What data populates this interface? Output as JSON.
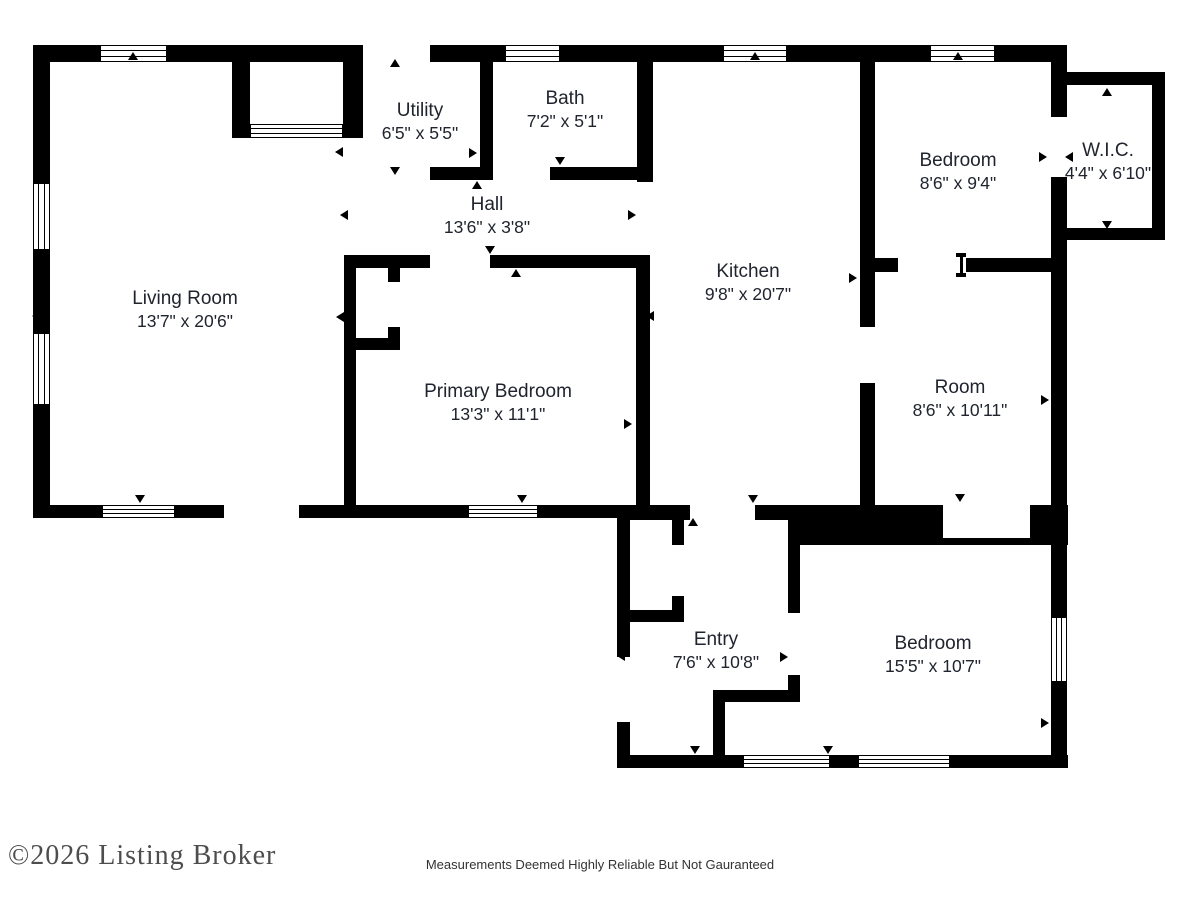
{
  "floor_plan": {
    "rooms": [
      {
        "id": "living-room",
        "name": "Living Room",
        "dims": "13'7\" x 20'6\"",
        "cx": 185,
        "cy": 310
      },
      {
        "id": "utility",
        "name": "Utility",
        "dims": "6'5\" x 5'5\"",
        "cx": 420,
        "cy": 122
      },
      {
        "id": "bath",
        "name": "Bath",
        "dims": "7'2\" x 5'1\"",
        "cx": 565,
        "cy": 110
      },
      {
        "id": "hall",
        "name": "Hall",
        "dims": "13'6\" x 3'8\"",
        "cx": 487,
        "cy": 216
      },
      {
        "id": "kitchen",
        "name": "Kitchen",
        "dims": "9'8\" x 20'7\"",
        "cx": 748,
        "cy": 283
      },
      {
        "id": "bedroom-top",
        "name": "Bedroom",
        "dims": "8'6\" x 9'4\"",
        "cx": 958,
        "cy": 172
      },
      {
        "id": "wic",
        "name": "W.I.C.",
        "dims": "4'4\" x 6'10\"",
        "cx": 1108,
        "cy": 162
      },
      {
        "id": "room",
        "name": "Room",
        "dims": "8'6\" x 10'11\"",
        "cx": 960,
        "cy": 399
      },
      {
        "id": "primary-bedroom",
        "name": "Primary Bedroom",
        "dims": "13'3\" x 11'1\"",
        "cx": 498,
        "cy": 403
      },
      {
        "id": "entry",
        "name": "Entry",
        "dims": "7'6\" x 10'8\"",
        "cx": 716,
        "cy": 651
      },
      {
        "id": "bedroom-bottom",
        "name": "Bedroom",
        "dims": "15'5\" x 10'7\"",
        "cx": 933,
        "cy": 655
      }
    ],
    "footer": {
      "copyright": "©2026 Listing Broker",
      "disclaimer": "Measurements Deemed Highly Reliable But Not Gauranteed"
    },
    "colors": {
      "wall": "#000000",
      "label_text": "#20242e",
      "copyright_text": "#4d4d4d",
      "disclaimer_text": "#333333",
      "background": "#ffffff"
    }
  }
}
